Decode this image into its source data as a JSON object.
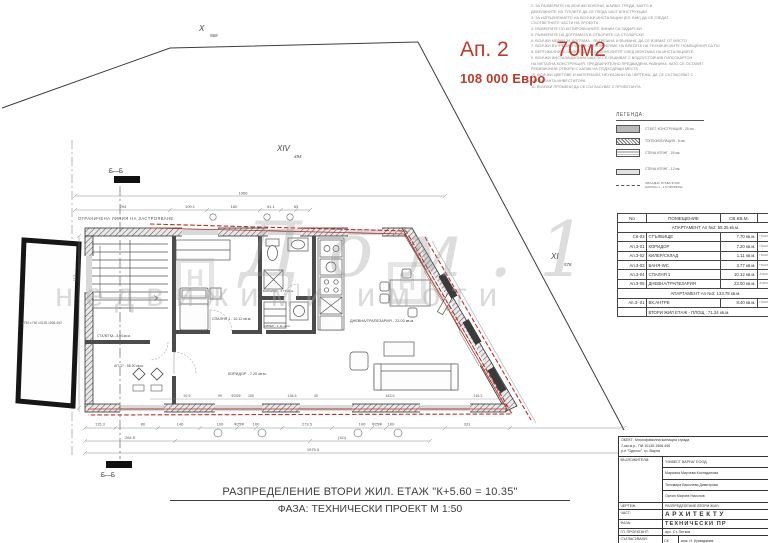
{
  "annotation": {
    "apartment_label": "Ап. 2",
    "area_label": "70м2",
    "price_label": "108 000 Евро",
    "accent_color": "#c0392b"
  },
  "notes": {
    "lines": [
      "2. ЗА РАЗМЕРИТЕ НА ВСИЧКИ КОЛОНИ, ШАЙБИ, ГРЕДИ, КАКТО И",
      "ДЕБЕЛИНИТЕ НА ТУХЛИТЕ ДА СЕ ГЛЕДА ЧАСТ КОНСТРУКЦИИ",
      "3. ЗА ИЗПЪЛНЕНИЕТО НА ВСИЧКИ ИНСТАЛАЦИИ (ЕЛ. ВИК) ДА СЕ ГЛЕДАТ",
      "СЪОТВЕТНИТЕ ЧАСТИ НА ПРОЕКТА",
      "4. РАЗМЕРИТЕ ПО КОТИРОВЪЧНИТЕ ЛИНИИ СА ЗИДАРСКИ",
      "5. РАЗМЕРИТЕ НА ДОГРАМАТА В ОТВОРИТЕ СА СТОЛАРСКИ",
      "6. ВСИЧКИ МЕРКИ ЗА ДОГРАМА - ВЪТРЕШНА И ВЪНШНА, ДА СЕ ВЗЕМАТ ОТ МЯСТО",
      "7. ВСИЧКИ ВЪТРЕШНИ ВРАТИ С ИЗКЛЮЧЕНИЕ НА ВРАТИТЕ НА ТЕХНИЧЕСКИТЕ ПОМЕЩЕНИЯ СА ПО",
      "8. ВЕРТИКАЛНИТЕ ШАЙБИ ДА СЕ ЗАМОНОЛИТЯТ СЛЕД МОНТАЖА НА ИНСТАЛАЦИИТЕ",
      "9. ВСИЧКИ ИНСТАЛАЦИОННИ ШАХТИ СЕ ОБШИВАТ С ВОДОУСТОЙЧИВ ГИПСОКАРТОН",
      "НА МЕТАЛНА КОНСТРУКЦИЯ. ПРЕДВАРИТЕЛНО ПРЕДВИДЕНА РАВНИНА, КАТО СЕ ОСТАВЯТ",
      "РЕВИЗИОННИ ОТВОРИ С КАПАК НА ПОДХОДЯЩИ МЕСТА",
      "10. ВСИЧКИ ЦВЕТОВЕ И МАТЕРИАЛИ, НЕУКАЗАНИ НА ЧЕРТЕЖА, ДА СЕ СЪГЛАСУВАТ С",
      "ПРОЕКТАНТА-ИНВЕСТИТОРА",
      "11. ВСИЧКИ ПРОМЕНИ ДА СЕ СЪГЛАСУВАТ С ПРОЕКТАНТА"
    ]
  },
  "legend": {
    "title": "ЛЕГЕНДА:",
    "item1": "СТ.БЕТ. КОНСТРУКЦИЯ - 25 см.",
    "item2": "ТОПЛОИЗОЛАЦИЯ - 8 см.",
    "item3": "СТЕНА ИТОНГ - 25 см.",
    "item4": "СТЕНА ИТОНГ - 12 см.",
    "item5_line1": "ОБСАДНА ТРЪБА Ф 200",
    "item5_line2": "НАКЛОН 1 - 1.5 ПРОМИЛА"
  },
  "site": {
    "parcel_top_id": "X",
    "parcel_top_num": "569",
    "parcel_mid_id": "XIV",
    "parcel_mid_num": "494",
    "parcel_right_id": "XI",
    "parcel_right_num": "578",
    "parcel_left_id": "I",
    "parcel_left_num": "492",
    "neighbor_parcel": "УПИ с ПИ 10135.1506.492",
    "restriction_line": "ОГРАНИЧЕНА ЛИНИЯ НА ЗАСТРОЯВАНЕ"
  },
  "plan": {
    "section_marker": "Б—Б",
    "room_bedroom": "СПАЛНЯ 1 - 10.12 кв.м.",
    "room_bath": "БАНЯ/WC - 3.77 кв.м.",
    "room_closet": "КИЛЕР - 1.11 кв.м.",
    "room_corridor": "КОРИДОР - 7.20 кв.м.",
    "room_living": "ДНЕВНА/ТРАПЕЗАРИЯ - 23.00 кв.м.",
    "room_stairs": "СТ.КЛЕТКА - 8.04 кв.м.",
    "room_apartment": "АП \"2\" - 55.20 кв.м.",
    "dim_total_top": "1066",
    "dims_top": [
      "294",
      "109.1",
      "160",
      "61.1",
      "83"
    ],
    "dims_mid": [
      "92.5",
      "99",
      "Ф25Ф",
      "100",
      "136.5",
      "40",
      "443.5",
      "116.3"
    ],
    "dims_bottom": [
      "115.3",
      "80",
      "146",
      "100",
      "Ф25Ф",
      "100",
      "273.5",
      "100",
      "Ф25Ф",
      "100",
      "331"
    ],
    "dims_bottom2": [
      "264.5",
      "(111)"
    ],
    "dim_total_bottom": "1575.5",
    "dim_left": "117"
  },
  "watermark": {
    "script": "Дом.1",
    "text": "недвижими имоти",
    "logo": "Н"
  },
  "area_table": {
    "col_no": "No",
    "col_room": "ПОМЕЩЕНИЕ",
    "col_area": "СВ.КВ.М.",
    "col_floor": "ПОД",
    "group1": "АПАРТАМЕНТ Ап №2: 55.25 кв.м.",
    "rows": [
      {
        "no": "СК-03",
        "room": "СТЪЛБИЩЕ",
        "area": "7.70 кв.м.",
        "floor": "ГРАНИТОГРЕС"
      },
      {
        "no": "Ап.3-01",
        "room": "КОРИДОР",
        "area": "7.20 кв.м.",
        "floor": "ГРАНИТОГРЕС"
      },
      {
        "no": "Ап.3-02",
        "room": "КИЛЕР/СКЛАД",
        "area": "1.11 кв.м.",
        "floor": "ГРАНИТОГРЕС"
      },
      {
        "no": "Ап.3-03",
        "room": "БАНЯ-WC",
        "area": "3.77 кв.м.",
        "floor": "ГРАНИТОГРЕС"
      },
      {
        "no": "Ап.3-04",
        "room": "СПАЛНЯ 1",
        "area": "10.12 кв.м.",
        "floor": "ЛАМИНАТ"
      },
      {
        "no": "Ап.3-05",
        "room": "ДНЕВНА/ТРАПЕЗАРИЯ",
        "area": "23.00 кв.м.",
        "floor": "ЛАМИНАТ"
      }
    ],
    "group2": "АПАРТАМЕНТ Ап №3: 133.78 кв.м.",
    "rows2": [
      {
        "no": "Ап.3- 01",
        "room": "ВХ.АНТРЕ",
        "area": "8.40 кв.м.",
        "floor": "ГРАНИТОГРЕС"
      }
    ],
    "footer": "ВТОРИ ЖИЛ ЕТАЖ - ПЛОЩ : 71.34 кв.м."
  },
  "footer_title": {
    "line1": "РАЗПРЕДЕЛЕНИЕ ВТОРИ ЖИЛ. ЕТАЖ \"К+5.60 = 10.35\"",
    "line2": "ФАЗА: ТЕХНИЧЕСКИ ПРОЕКТ М 1:50"
  },
  "title_block": {
    "obekt_label": "ОБЕКТ:",
    "obekt_line1": "Многофамилна жилищна сграда",
    "obekt_line2": "7-ми м.р., ПИ 10135.1506.496",
    "obekt_line3": "р-н \"Одесос\", гр. Варна",
    "client_label": "ВЪЗЛОЖИТЕЛИ:",
    "client1": "\"ИНВЕСТ ВАРНА\" ЕООД",
    "client2": "Мариана Мирчева Костадинова",
    "client3": "Тихомира Василева Димитрова",
    "client4": "Орлин Мирчев Николов",
    "chertezh_label": "ЧЕРТЕЖ:",
    "chertezh_value": "РАЗПРЕДЕЛЕНИЕ ВТОРИ ЖИЛ.",
    "chast_label": "ЧАСТ:",
    "chast_value": "АРХИТЕКТУ",
    "faza_label": "ФАЗА:",
    "faza_value": "ТЕХНИЧЕСКИ ПР",
    "gp_label": "ГЛ. ПРОЕКТАНТ:",
    "gp_value": "арх. Ст. Петков",
    "sagl_label": "СЪГЛАСУВАЛИ:",
    "sagl1_code": "СК",
    "sagl1_name": "инж. Н. Куюмджиев",
    "sagl2_code": "ЕЛ",
    "sagl2_name": "инж. Пл. Стоянов"
  }
}
